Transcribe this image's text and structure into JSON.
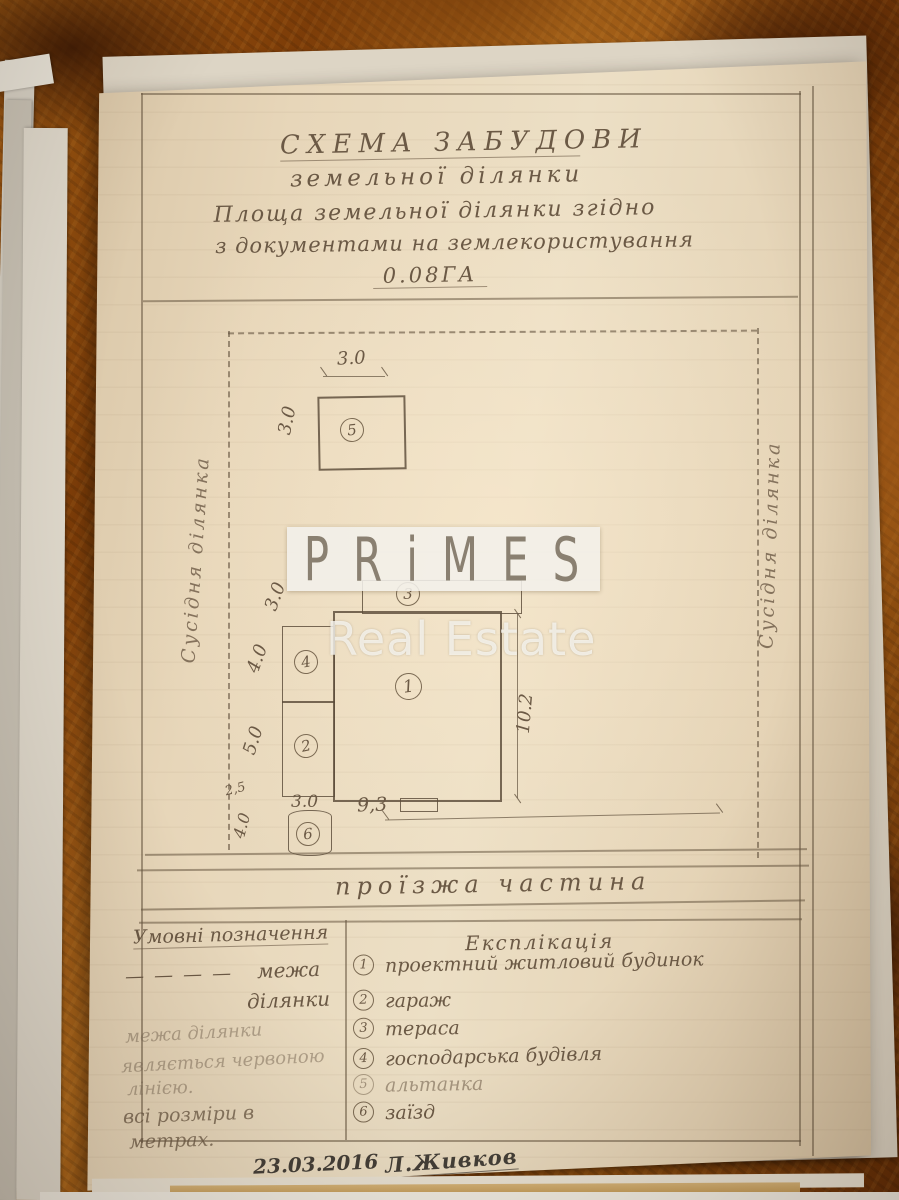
{
  "document": {
    "title": {
      "line1": "СХЕМА ЗАБУДОВИ",
      "line2": "земельної ділянки",
      "line3": "Площа земельної ділянки згідно",
      "line4": "з документами на землекористування",
      "area": "0.08ГА"
    },
    "plan": {
      "neighbor_left": "Сусідня ділянка",
      "neighbor_right": "Сусідня ділянка",
      "road": "проїзжа частина",
      "buildings": {
        "b1": "1",
        "b2": "2",
        "b3": "3",
        "b4": "4",
        "b5": "5",
        "b6": "6"
      },
      "dims": {
        "b5_width": "3.0",
        "b5_height": "3.0",
        "left_top": "3.0",
        "b4_height": "4.0",
        "b2_height": "5.0",
        "offset": "2,5",
        "b6_height": "4.0",
        "b6_width": "3.0",
        "b1_width": "9,3",
        "b1_height": "10.2"
      }
    },
    "legend": {
      "left_header": "Умовні позначення",
      "boundary_symbol": "— — — —",
      "boundary_label_1": "межа",
      "boundary_label_2": "ділянки",
      "note_1": "межа ділянки",
      "note_2": "являється червоною",
      "note_3": "лінією.",
      "note_4": "всі розміри в",
      "note_5": "метрах.",
      "right_header": "Експлікація",
      "items": [
        {
          "num": "1",
          "label": "проектний житловий будинок"
        },
        {
          "num": "2",
          "label": "гараж"
        },
        {
          "num": "3",
          "label": "тераса"
        },
        {
          "num": "4",
          "label": "господарська будівля"
        },
        {
          "num": "5",
          "label": "альтанка"
        },
        {
          "num": "6",
          "label": "заїзд"
        }
      ]
    },
    "footer": {
      "date": "23.03.2016",
      "signature": "Л.Живков"
    }
  },
  "watermark": {
    "brand": "PRiMES",
    "subtitle": "Real Estate"
  },
  "colors": {
    "pencil": "#6b5945",
    "ink": "#443f38",
    "paper": "#e7d6b9",
    "table": "#94520f"
  }
}
